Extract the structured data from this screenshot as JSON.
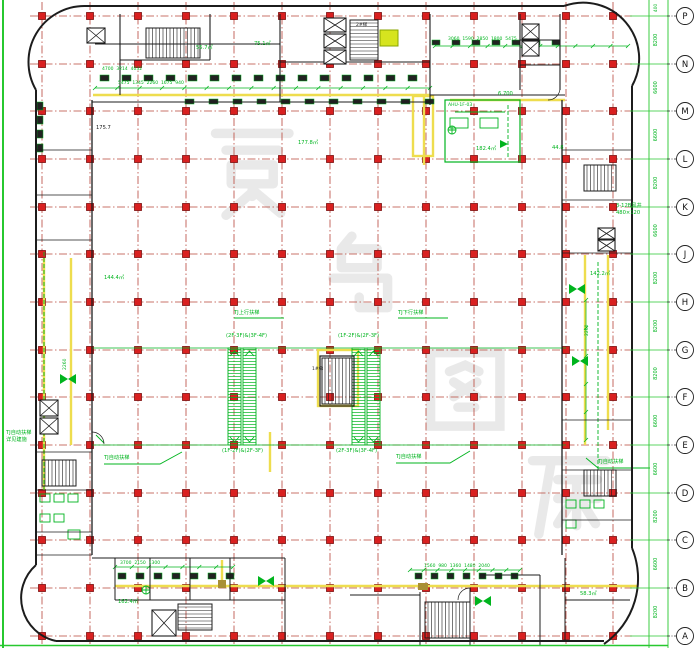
{
  "colors": {
    "bg": "#ffffff",
    "grid_red": "#b8453a",
    "column_red": "#d92020",
    "column_border": "#7c0f0f",
    "wall_black": "#1c1c1c",
    "anno_green": "#00b41e",
    "pipe_yellow": "#eedd4e",
    "highlight_yellow": "#d6e41f",
    "khaki": "#a98f35",
    "axis_green": "#27c82f",
    "watermark_gray": "rgba(120,120,120,0.13)"
  },
  "grid": {
    "columns_x": [
      42,
      90,
      138,
      186,
      234,
      282,
      330,
      378,
      426,
      474,
      522,
      566,
      613
    ],
    "rows_y": [
      16,
      64,
      111,
      159,
      207,
      254,
      302,
      350,
      397,
      445,
      493,
      540,
      588,
      636
    ],
    "square_size": 7
  },
  "axis_strip": {
    "labels": [
      "P",
      "N",
      "M",
      "L",
      "K",
      "J",
      "H",
      "G",
      "F",
      "E",
      "D",
      "C",
      "B",
      "A"
    ],
    "dims": [
      "8200",
      "6600",
      "6600",
      "8200",
      "6600",
      "8200",
      "8200",
      "8200",
      "6600",
      "6600",
      "8200",
      "6600",
      "8200"
    ],
    "top_dim": "400"
  },
  "watermark": {
    "text": "景鸟图库"
  },
  "annotations": [
    {
      "x": 196,
      "y": 46,
      "t": "55.7㎡"
    },
    {
      "x": 254,
      "y": 42,
      "t": "75.1㎡"
    },
    {
      "x": 298,
      "y": 141,
      "t": "177.8㎡"
    },
    {
      "x": 476,
      "y": 147,
      "t": "182.4㎡"
    },
    {
      "x": 590,
      "y": 272,
      "t": "142.2㎡"
    },
    {
      "x": 104,
      "y": 276,
      "t": "144.4㎡"
    },
    {
      "x": 498,
      "y": 92,
      "t": "6.700"
    },
    {
      "x": 552,
      "y": 146,
      "t": "44.8"
    },
    {
      "x": 226,
      "y": 334,
      "t": "(2F-3F)&(3F-4F)"
    },
    {
      "x": 338,
      "y": 334,
      "t": "(1F-2F)&(2F-3F)"
    },
    {
      "x": 222,
      "y": 449,
      "t": "(1F-2F)&(2F-3F)"
    },
    {
      "x": 336,
      "y": 449,
      "t": "(2F-3F)&(3F-4F)"
    },
    {
      "x": 104,
      "y": 456,
      "t": "TJ自动扶梯"
    },
    {
      "x": 396,
      "y": 455,
      "t": "TJ自动扶梯"
    },
    {
      "x": 598,
      "y": 460,
      "t": "TJ自动扶梯"
    },
    {
      "x": 234,
      "y": 311,
      "t": "TJ上行扶梯"
    },
    {
      "x": 398,
      "y": 311,
      "t": "TJ下行扶梯"
    },
    {
      "x": 6,
      "y": 431,
      "t": "TJ自动扶梯"
    },
    {
      "x": 6,
      "y": 438,
      "t": "详见建施"
    },
    {
      "x": 616,
      "y": 204,
      "t": "3-12B风井"
    },
    {
      "x": 616,
      "y": 211,
      "t": "480×120"
    },
    {
      "x": 118,
      "y": 82,
      "t": "5475  1345  2260  1675  940",
      "s": 4.5
    },
    {
      "x": 448,
      "y": 38,
      "t": "3060  1590  2850  1800  5475",
      "s": 4.5
    },
    {
      "x": 424,
      "y": 565,
      "t": "1560  980  1360  1480  2040",
      "s": 4.5
    },
    {
      "x": 120,
      "y": 562,
      "t": "3700  2150  1300",
      "s": 4.5
    },
    {
      "x": 102,
      "y": 68,
      "t": "4700  3214  4032",
      "s": 4.5
    },
    {
      "x": 118,
      "y": 600,
      "t": "162.4㎡"
    },
    {
      "x": 580,
      "y": 592,
      "t": "58.3㎡"
    },
    {
      "x": 448,
      "y": 104,
      "t": "AHU-1F-03",
      "s": 4.5
    },
    {
      "x": 64,
      "y": 370,
      "t": "2260",
      "r": -90,
      "s": 4.5
    },
    {
      "x": 586,
      "y": 336,
      "t": "2260",
      "r": -90,
      "s": 4.5
    },
    {
      "x": 96,
      "y": 126,
      "t": "175.7",
      "c": "#1c1c1c"
    },
    {
      "x": 312,
      "y": 368,
      "t": "1#梯",
      "c": "#1c1c1c",
      "s": 4.5
    },
    {
      "x": 356,
      "y": 24,
      "t": "2#梯",
      "c": "#1c1c1c",
      "s": 4.5
    }
  ]
}
